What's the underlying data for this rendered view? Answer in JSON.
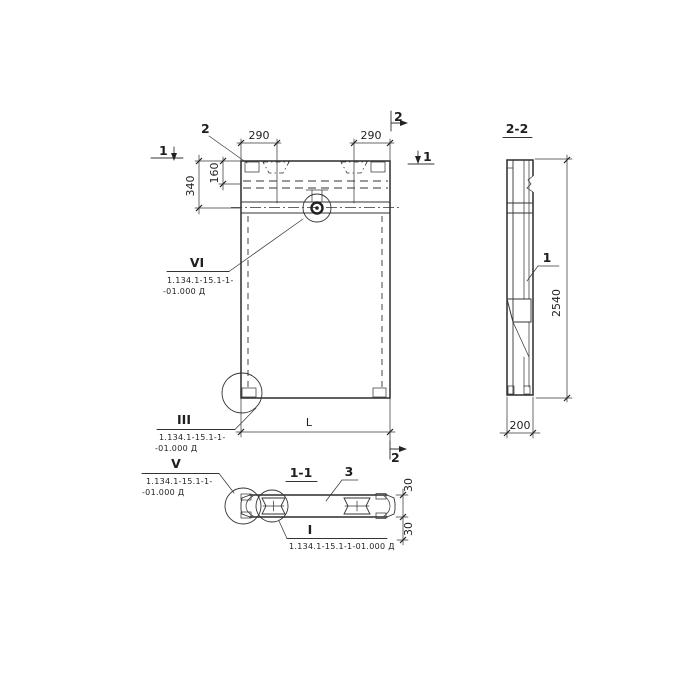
{
  "palette": {
    "ink": "#2b2b2b",
    "background": "#ffffff"
  },
  "front_view": {
    "marker_1_left": "1",
    "marker_1_right": "1",
    "marker_2_top": "2",
    "marker_2_bottom": "2",
    "callout_top_left": "2",
    "dim_end_zone_left": "290",
    "dim_end_zone_right": "290",
    "dim_top_band": "340",
    "dim_recess_depth": "160",
    "dim_length": "L",
    "detail_vi": {
      "label": "VI",
      "ref_line1": "1.134.1-15.1-1-",
      "ref_line2": "-01.000 Д"
    },
    "detail_iii": {
      "label": "III",
      "ref_line1": "1.134.1-15.1-1-",
      "ref_line2": "-01.000 Д"
    }
  },
  "section_1_1": {
    "title": "1-1",
    "callout_slab": "3",
    "dim_flange_top": "30",
    "dim_flange_bottom": "30",
    "detail_v": {
      "label": "V",
      "ref_line1": "1.134.1-15.1-1-",
      "ref_line2": "-01.000 Д"
    },
    "detail_i": {
      "label": "I",
      "ref_line1": "1.134.1-15.1-1-01.000 Д"
    }
  },
  "section_2_2": {
    "title": "2-2",
    "callout_rib": "1",
    "dim_height": "2540",
    "dim_thickness": "200"
  }
}
